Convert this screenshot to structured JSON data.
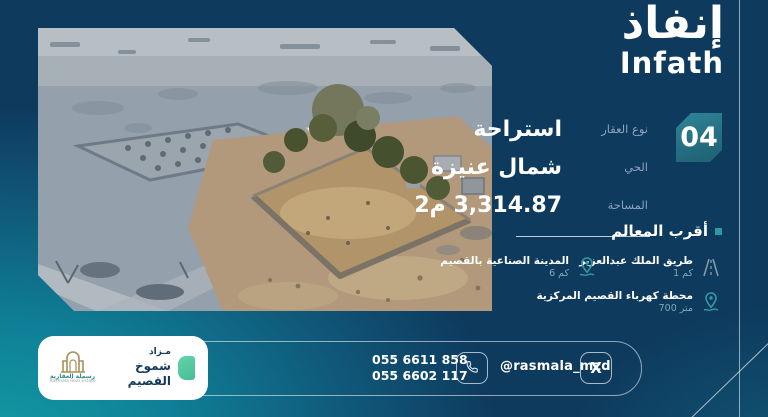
{
  "brand": {
    "name_ar": "إنفاذ",
    "name_en": "Infath"
  },
  "lot": {
    "number": "04"
  },
  "property": {
    "rows": [
      {
        "label": "نوع العقار",
        "value": "استراحة"
      },
      {
        "label": "الحي",
        "value": "شمال عنيزة"
      },
      {
        "label": "المساحة",
        "value": "3,314.87 م2"
      }
    ]
  },
  "landmarks": {
    "title": "أقرب المعالم",
    "items": [
      {
        "name": "طريق الملك عبدالعزيز",
        "distance": "1 كم",
        "icon": "road-icon"
      },
      {
        "name": "المدينة الصناعية بالقصيم",
        "distance": "6 كم",
        "icon": "map-pin-icon"
      },
      {
        "name": "محطة كهرباء القصيم المركزية",
        "distance": "700 متر",
        "icon": "map-pin-icon"
      }
    ]
  },
  "footer": {
    "phones": [
      "055 6611 858",
      "055 6602 117"
    ],
    "handle": "@rasmala_mzd",
    "x_glyph": "X",
    "auction": {
      "line1": "مـزاد",
      "line2": "شموخ القصيم"
    },
    "realestate": {
      "name_ar": "رسملة العقارية",
      "name_en": "Rasmala Real Estate"
    }
  },
  "colors": {
    "navy": "#0e3a5e",
    "teal_glow": "#129aa4",
    "badge_teal": "#256f82",
    "mint": "#56c8a2",
    "label_gray": "#8ca3bd",
    "pin_teal": "#35989e"
  }
}
